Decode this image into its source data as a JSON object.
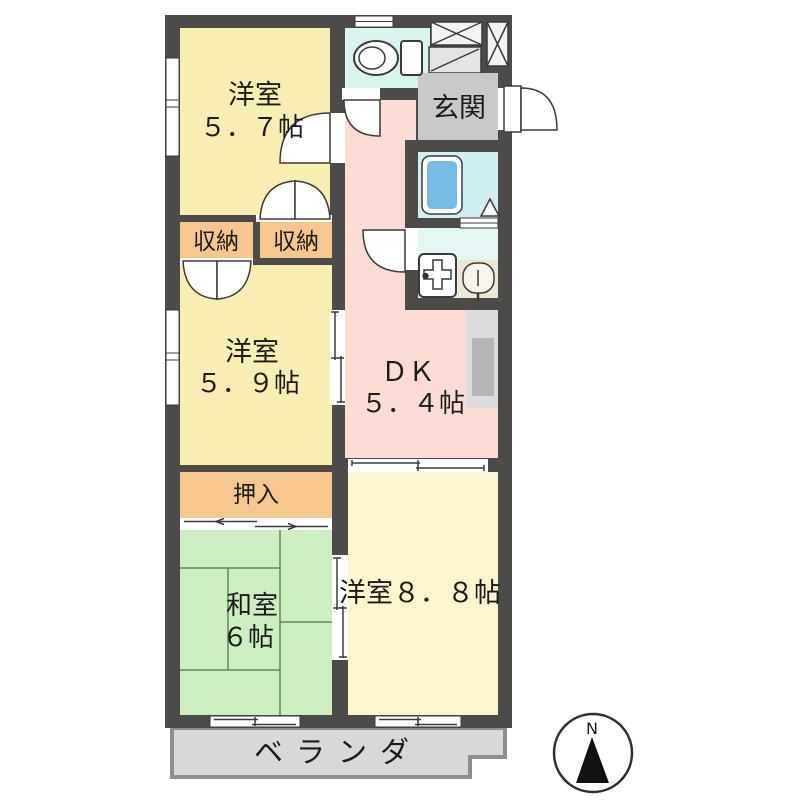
{
  "colors": {
    "wall": "#4c4b49",
    "western_room": "#f8eeb2",
    "western_room_large": "#fbf5cd",
    "japanese_room": "#cdeec0",
    "dining_kitchen": "#fadcd2",
    "storage": "#f6c78c",
    "toilet": "#d9f3ef",
    "bath": "#cfeff0",
    "washroom": "#e2f7f4",
    "entrance": "#c9c9c9",
    "shoe_cabinet": "#e3e3e3",
    "counter": "#dcdcdc",
    "counter_inner": "#b5b5b5",
    "tub": "#74bce6",
    "basin_pad": "#ece6d2",
    "veranda": "#d8d8d8",
    "veranda_border": "#8e8e8e"
  },
  "rooms": {
    "western_57": {
      "name": "洋室",
      "size": "５．７帖"
    },
    "western_59": {
      "name": "洋室",
      "size": "５．９帖"
    },
    "western_88": {
      "label": "洋室８．８帖"
    },
    "japanese": {
      "name": "和室",
      "size": "６帖"
    },
    "dk": {
      "name": "ＤＫ",
      "size": "５．４帖"
    },
    "entrance": {
      "label": "玄関"
    },
    "oshiire": {
      "label": "押入"
    },
    "closet_left": {
      "label": "収納"
    },
    "closet_right": {
      "label": "収納"
    },
    "veranda": {
      "label": "ベランダ"
    }
  },
  "compass": {
    "north": "N"
  }
}
